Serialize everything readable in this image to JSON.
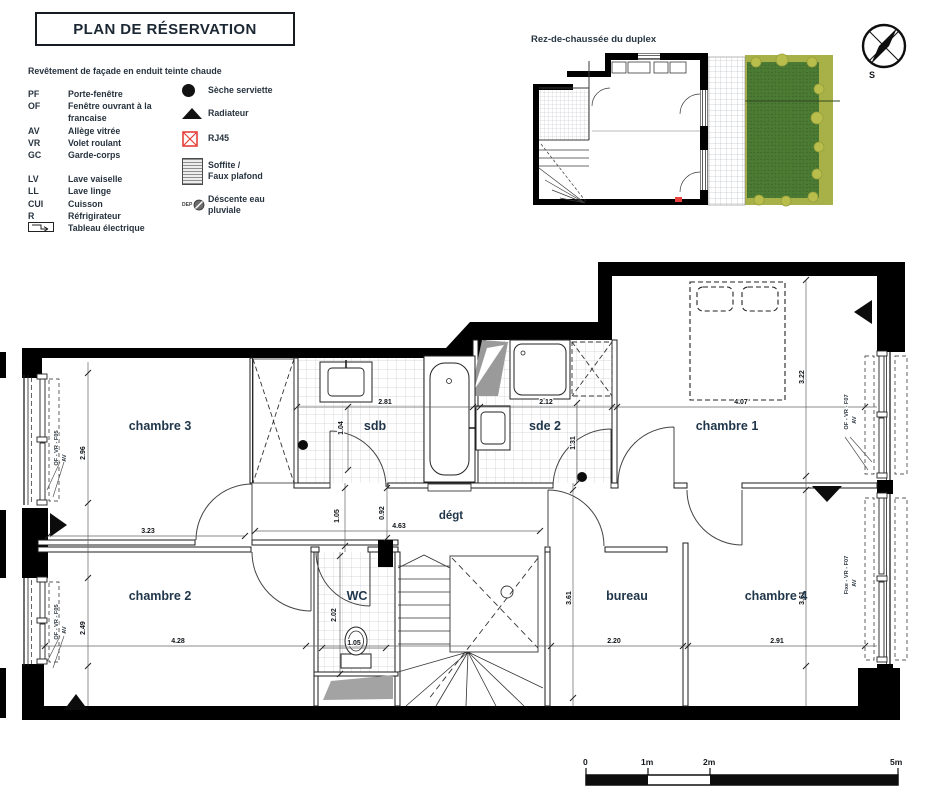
{
  "title": "PLAN DE RÉSERVATION",
  "facade_note": "Revêtement de façade en enduit teinte chaude",
  "legend": {
    "abbr": [
      {
        "k": "PF",
        "v": "Porte-fenêtre"
      },
      {
        "k": "OF",
        "v": "Fenêtre ouvrant à la francaise"
      },
      {
        "k": "AV",
        "v": "Allège vitrée"
      },
      {
        "k": "VR",
        "v": "Volet roulant"
      },
      {
        "k": "GC",
        "v": "Garde-corps"
      },
      {
        "k": "LV",
        "v": "Lave vaiselle"
      },
      {
        "k": "LL",
        "v": "Lave linge"
      },
      {
        "k": "CUI",
        "v": "Cuisson"
      },
      {
        "k": "R",
        "v": "Réfrigirateur"
      },
      {
        "k": "",
        "v": "Tableau électrique"
      }
    ],
    "symbols": {
      "seche": "Sèche serviette",
      "radiateur": "Radiateur",
      "rj45": "RJ45",
      "soffite_1": "Soffite /",
      "soffite_2": "Faux plafond",
      "dep": "DEP",
      "descente_1": "Déscente eau",
      "descente_2": "pluviale"
    }
  },
  "inset": {
    "title": "Rez-de-chaussée du duplex"
  },
  "compass": {
    "south": "S"
  },
  "rooms": {
    "ch3": "chambre 3",
    "sdb": "sdb",
    "sde2": "sde 2",
    "ch1": "chambre 1",
    "ch2": "chambre 2",
    "wc": "WC",
    "degt": "dégt",
    "bureau": "bureau",
    "ch4": "chambre 4"
  },
  "dims": {
    "sdb_w": "2.81",
    "sde2_w": "2.12",
    "ch1_w": "4.07",
    "ch1_h": "3.22",
    "sdb_v": "1.04",
    "sde2_v": "1.31",
    "ch3_w": "3.23",
    "ch3_h": "2.96",
    "degt_w": "4.63",
    "degt_v1": "1.05",
    "degt_v2": "0.92",
    "wc_h": "2.02",
    "wc_w": "1.05",
    "ch2_w": "4.28",
    "ch2_h": "2.49",
    "bureau_w": "2.20",
    "bureau_h": "3.61",
    "ch4_w": "2.91",
    "ch4_h": "3.61"
  },
  "windows": {
    "f05": "OF - VR - F05",
    "f07": "OF - VR - F07",
    "fixe": "Fixe - VR - F07",
    "av": "AV"
  },
  "scalebar": {
    "m0": "0",
    "m1": "1m",
    "m2": "2m",
    "m5": "5m"
  },
  "colors": {
    "rj45_red": "#e8403a",
    "garden_green": "#4c7b33",
    "bush_green": "#b9bd4b"
  }
}
